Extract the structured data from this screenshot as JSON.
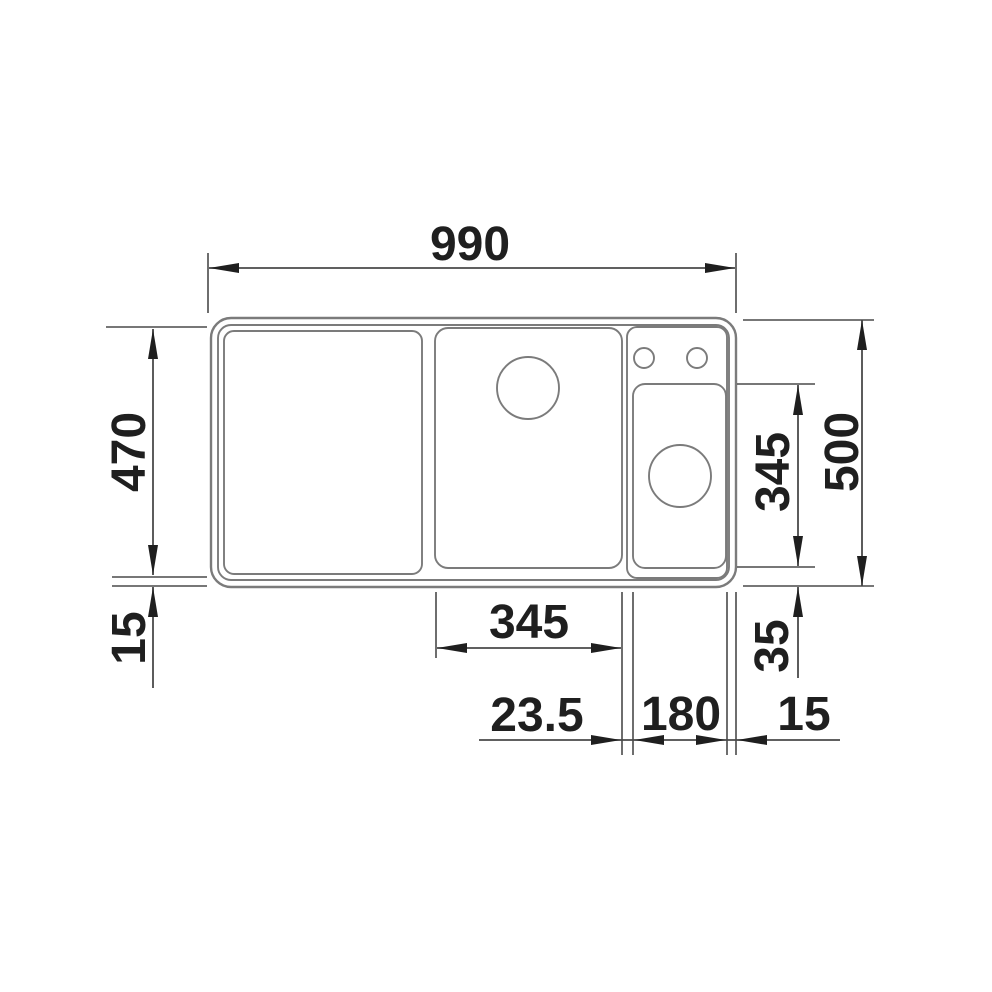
{
  "diagram": {
    "title": "Sink dimension drawing, top view",
    "unit": "mm",
    "colors": {
      "background": "#ffffff",
      "outline": "#7b7b7b",
      "dimension_line": "#4a4a4a",
      "arrow": "#1f1f1f",
      "label": "#1f1f1f"
    },
    "features": [
      "left-drainboard",
      "main-bowl",
      "main-bowl-drain-hole",
      "accessory-compartment",
      "right-bowl",
      "right-bowl-drain-hole",
      "tap-hole-1",
      "tap-hole-2"
    ],
    "dimensions": {
      "overall_width": "990",
      "inner_depth": "470",
      "rim_bottom_left": "15",
      "right_bowl_depth": "345",
      "right_bowl_bottom_offset": "35",
      "overall_depth": "500",
      "main_bowl_width": "345",
      "divider_width": "23.5",
      "right_bowl_width": "180",
      "rim_right": "15"
    }
  }
}
